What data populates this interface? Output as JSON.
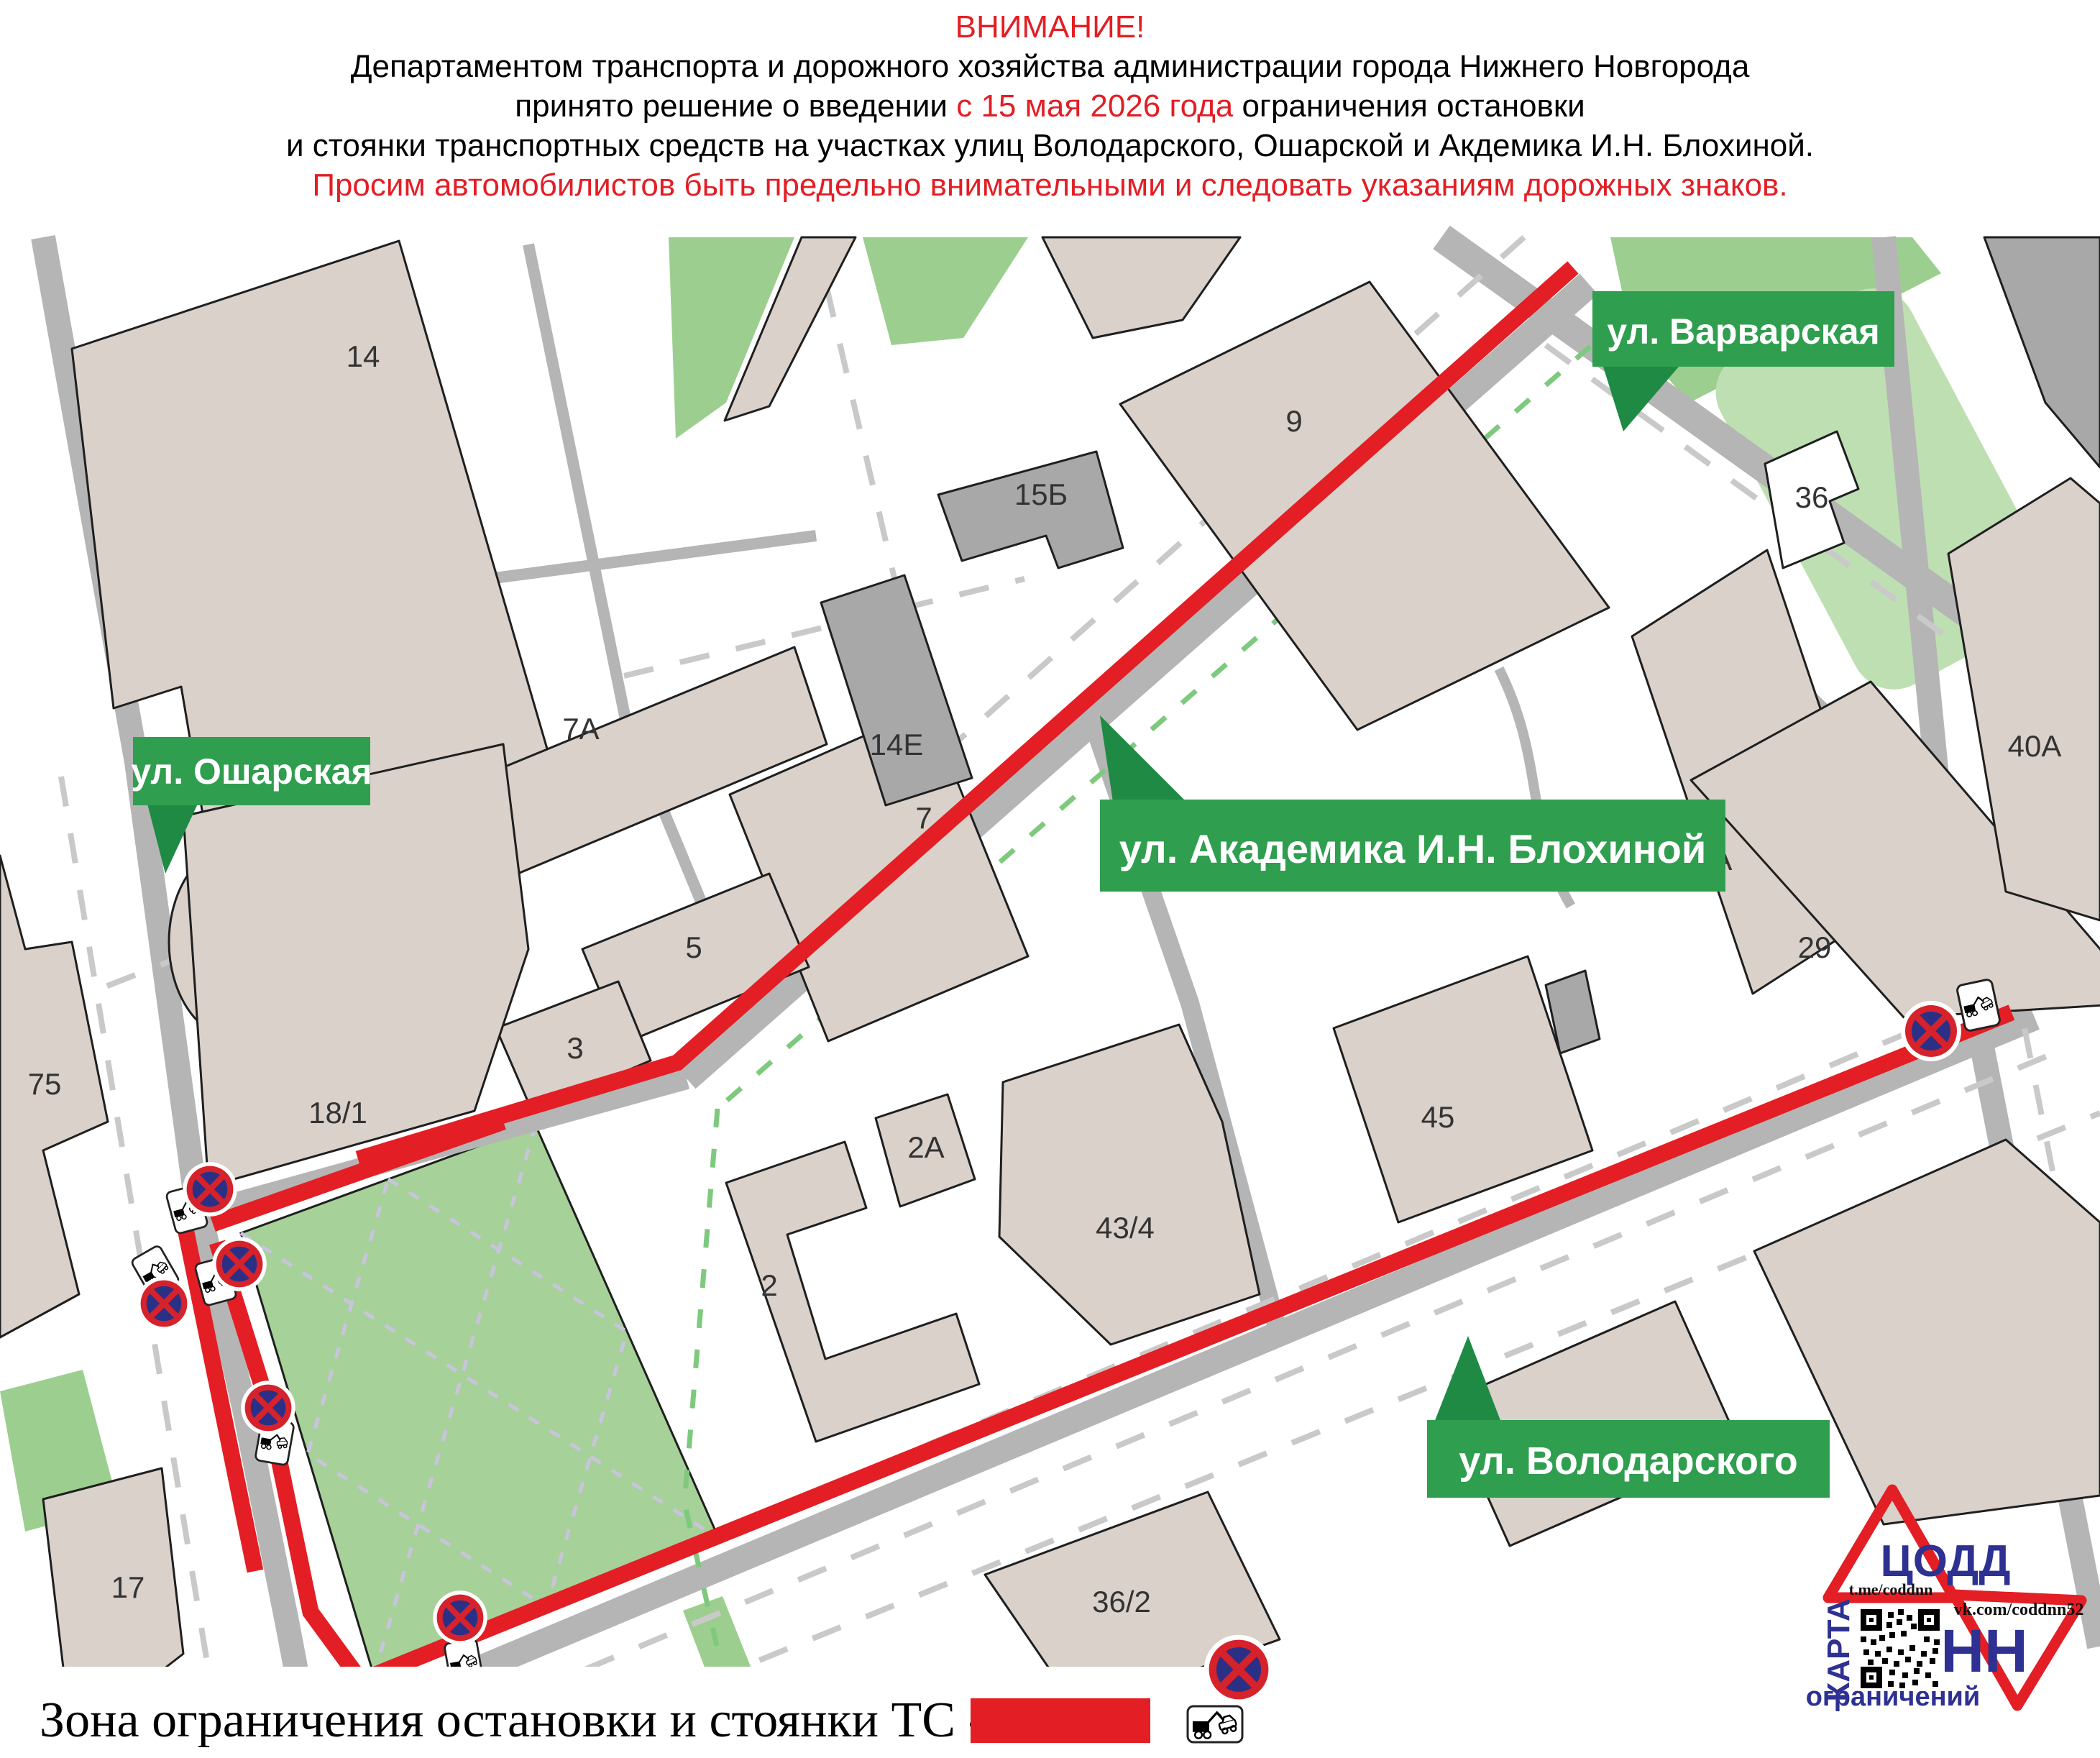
{
  "header": {
    "title": "ВНИМАНИЕ!",
    "line2": "Департаментом транспорта и дорожного хозяйства администрации города Нижнего Новгорода",
    "line3_pre": "принято решение о введении ",
    "line3_red": "с 15 мая 2026 года",
    "line3_post": " ограничения остановки",
    "line4": "и стоянки транспортных средств на участках улиц Володарского, Ошарской и Акдемика И.Н. Блохиной.",
    "line5": "Просим автомобилистов быть предельно внимательными и следовать указаниям дорожных знаков."
  },
  "street_labels": {
    "varvarskaya": "ул. Варварская",
    "osharskaya": "ул. Ошарская",
    "blokhinoy": "ул. Академика И.Н. Блохиной",
    "volodarskogo": "ул. Володарского"
  },
  "building_numbers": {
    "b14": "14",
    "b14e": "14Е",
    "b15b": "15Б",
    "b7a": "7А",
    "b7": "7",
    "b9": "9",
    "b5": "5",
    "b3": "3",
    "b18_1": "18/1",
    "b75": "75",
    "b17": "17",
    "b2": "2",
    "b2a": "2А",
    "b43_4": "43/4",
    "b45": "45",
    "b36_2": "36/2",
    "b27a": "27А",
    "b29": "29",
    "b36": "36",
    "b40a": "40А"
  },
  "legend": {
    "text": "Зона ограничения остановки и стоянки ТС -"
  },
  "logo": {
    "org": "ЦОДД",
    "city": "НН",
    "telegram": "t.me/coddnn",
    "vk": "vk.com/coddnn52",
    "map_word": "КАРТА",
    "restrictions_word": "ограничений"
  },
  "signs": {
    "no_stopping": "Остановка запрещена",
    "tow_plate": "Работает эвакуатор"
  },
  "colors": {
    "accent_red": "#e31e24",
    "flag_green": "#2f9e4f",
    "park_green": "#a6d198",
    "road_gray": "#b5b5b5",
    "building_beige": "#d9d1ca",
    "building_gray": "#a8a8a8",
    "sign_blue": "#2b3087",
    "logo_blue": "#2e3192"
  }
}
